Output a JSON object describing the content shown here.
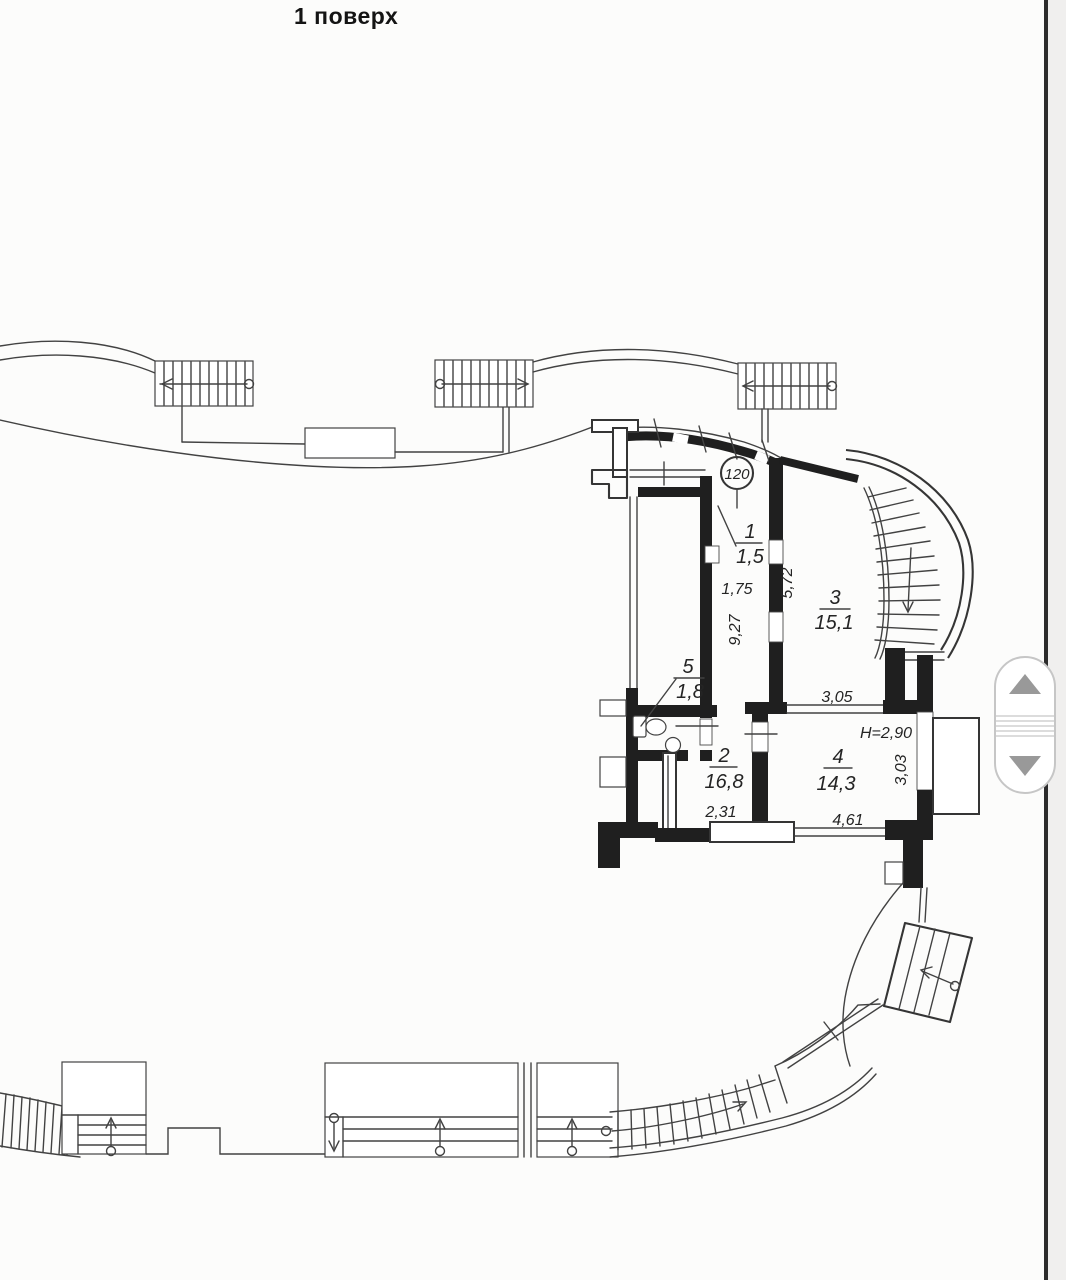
{
  "page": {
    "title": "1 поверх"
  },
  "plan": {
    "unit_number": "120",
    "rooms": [
      {
        "num": "1",
        "area": "1,5"
      },
      {
        "num": "2",
        "area": "16,8"
      },
      {
        "num": "3",
        "area": "15,1"
      },
      {
        "num": "4",
        "area": "14,3"
      },
      {
        "num": "5",
        "area": "1,8"
      }
    ],
    "dimensions": {
      "hall_width": "1,75",
      "hall_length": "9,27",
      "hall_room3_wall": "5,72",
      "room3_width": "3,05",
      "ceiling_height": "H=2,90",
      "room4_depth": "3,03",
      "room2_width": "2,31",
      "room4_width": "4,61"
    },
    "colors": {
      "wall": "#1f1f1f",
      "line": "#424242",
      "paper": "#fcfcfb"
    }
  }
}
